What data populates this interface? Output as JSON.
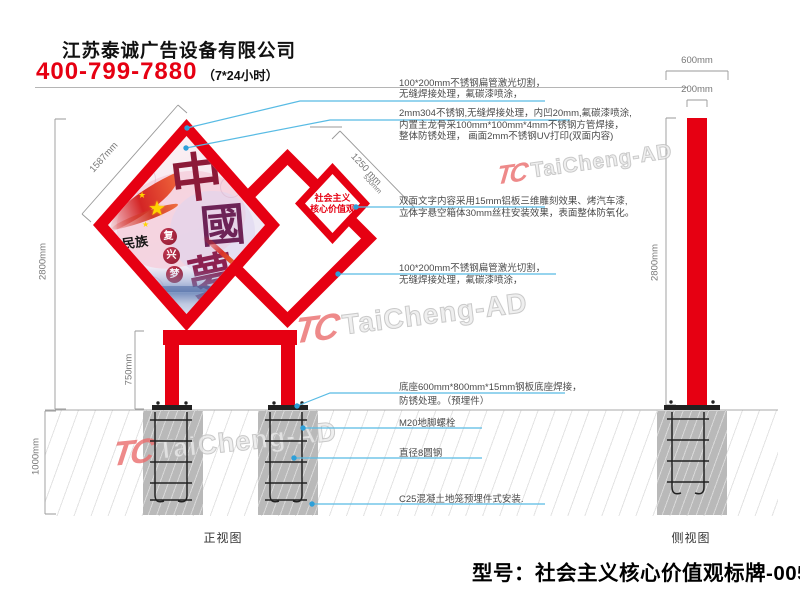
{
  "header": {
    "company": "江苏泰诚广告设备有限公司",
    "phone": "400-799-7880",
    "hours": "（7*24小时）"
  },
  "drawing": {
    "front_view_label": "正视图",
    "side_view_label": "侧视图",
    "model_title": "型号：社会主义核心价值观标牌-0056"
  },
  "panel": {
    "char1": "中",
    "char2": "國",
    "char3": "夢",
    "sub_text": "民族",
    "circle1": "复",
    "circle2": "兴",
    "circle3": "梦",
    "star": "★",
    "small_line1": "社会主义",
    "small_line2": "核心价值观"
  },
  "dimensions": {
    "panel_diagonal": "1587mm",
    "front_height": "2800mm",
    "leg_height": "750mm",
    "foundation_depth": "1000mm",
    "small_panel_diagonal": "1250 mm",
    "small_panel_side": "530mm",
    "base_width": "600mm",
    "pole_width": "200mm",
    "side_height": "2800mm"
  },
  "annotations": [
    {
      "lines": [
        "100*200mm不锈钢扁管激光切割，",
        "无缝焊接处理，氟碳漆喷涂，"
      ]
    },
    {
      "lines": [
        "2mm304不锈钢,无缝焊接处理，内凹20mm,氟碳漆喷涂,",
        "内置主龙骨采100mm*100mm*4mm不锈钢方管焊接，",
        "整体防锈处理， 画面2mm不锈钢UV打印(双面内容)"
      ]
    },
    {
      "lines": [
        "双面文字内容采用15mm铝板三维雕刻效果、烤汽车漆,",
        "立体字悬空箱体30mm丝柱安装效果，表面整体防氧化。"
      ]
    },
    {
      "lines": [
        "100*200mm不锈钢扁管激光切割，",
        "无缝焊接处理，氟碳漆喷涂，"
      ]
    },
    {
      "lines": [
        "底座600mm*800mm*15mm钢板底座焊接，",
        "防锈处理。（预埋件）"
      ]
    },
    {
      "lines": [
        "M20地脚螺栓"
      ]
    },
    {
      "lines": [
        "直径8圆钢"
      ]
    },
    {
      "lines": [
        "C25混凝土地笼预埋件式安装."
      ]
    }
  ],
  "watermark": {
    "mark": "TC",
    "name": "TaiCheng-AD"
  },
  "colors": {
    "brand_red": "#e60012",
    "leader_blue": "#58bbe4",
    "dot_blue": "#2e9fd8",
    "concrete_gray": "#b9b9b9",
    "dim_gray": "#999999"
  }
}
